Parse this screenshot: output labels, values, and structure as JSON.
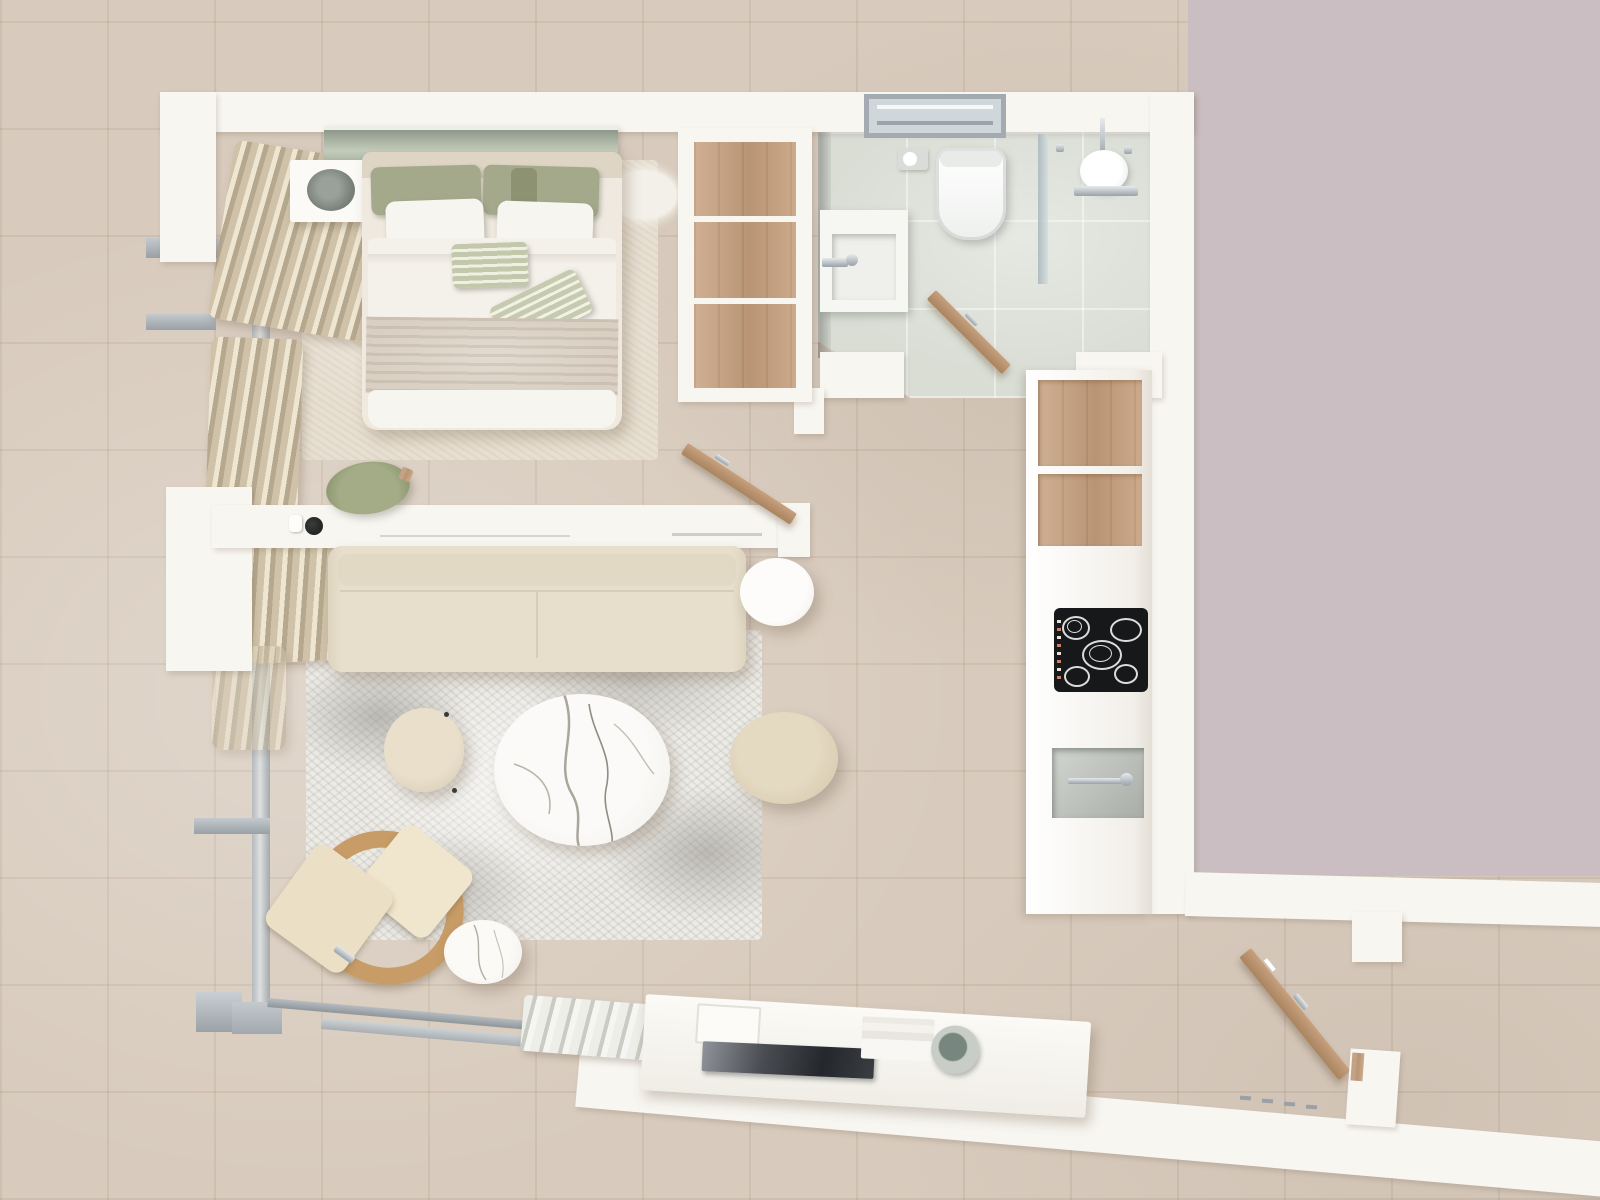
{
  "scene": {
    "title": "Studio apartment – top-down 3D floor plan render",
    "view": "top-down orthographic",
    "rooms": [
      {
        "id": "bedroom",
        "label": "sleeping area"
      },
      {
        "id": "living-room",
        "label": "living area"
      },
      {
        "id": "bathroom",
        "label": "bathroom with shower"
      },
      {
        "id": "kitchen",
        "label": "kitchenette"
      },
      {
        "id": "entry",
        "label": "entrance corridor"
      },
      {
        "id": "balcony",
        "label": "glazed terrace front"
      },
      {
        "id": "neighbor-area",
        "label": "adjacent unit (unrendered)"
      }
    ],
    "objects": {
      "bedroom": [
        "double-bed",
        "green-pillows",
        "white-pillows",
        "striped-accent-pillows",
        "foot-blanket",
        "headboard-glass-shelf",
        "hifi-speaker-box",
        "bedroom-rug",
        "sheepskin-rug",
        "desk-chair",
        "desk-halfwall",
        "wardrobe-open-shelves",
        "curtains"
      ],
      "living-room": [
        "sofa",
        "marble-coffee-table",
        "round-pouf-small",
        "round-pouf-large",
        "white-side-table",
        "lounge-chair",
        "small-marble-table",
        "distressed-rug",
        "tv-sideboard",
        "flat-tv",
        "media-speaker",
        "pleated-doormat",
        "sliding-glass-track"
      ],
      "bathroom": [
        "toilet",
        "toilet-paper-holder",
        "vanity-sink",
        "rain-shower-head",
        "shower-rail",
        "glass-partition",
        "bathroom-window",
        "bathroom-door"
      ],
      "kitchen": [
        "tall-cabinet-wood-shelves",
        "induction-cooktop",
        "kitchen-sink",
        "counter-run"
      ],
      "entry": [
        "entry-door",
        "entry-door-frame",
        "threshold-steps"
      ]
    }
  },
  "palette": {
    "floor": "#d8cbbd",
    "grout": "rgba(150,128,108,0.16)",
    "wall": "#f8f6f1",
    "wall_shade": "#e9e3da",
    "mauve": "#cbbec2",
    "wood": "#c7a07e",
    "wood_dark": "#a9845f",
    "bath_floor": "#d9ddd4",
    "glass": "#b9c3c9",
    "glass_green": "#b3bcae",
    "rug_bed": "#e7dfd1",
    "rug_living": "#edebe6",
    "sofa": "#e7dfcc",
    "cream": "#ece0c6",
    "cork": "#c79c66",
    "sage": "#a5a98c",
    "sage_dark": "#8d9372",
    "marble": "#f7f6f2",
    "chrome": "#b9c0c6",
    "cooktop": "#17181a",
    "tv": "#2e3236",
    "speaker": "#75847c",
    "sink_gray": "#b3b7b2",
    "mat": "#dfe1da"
  }
}
